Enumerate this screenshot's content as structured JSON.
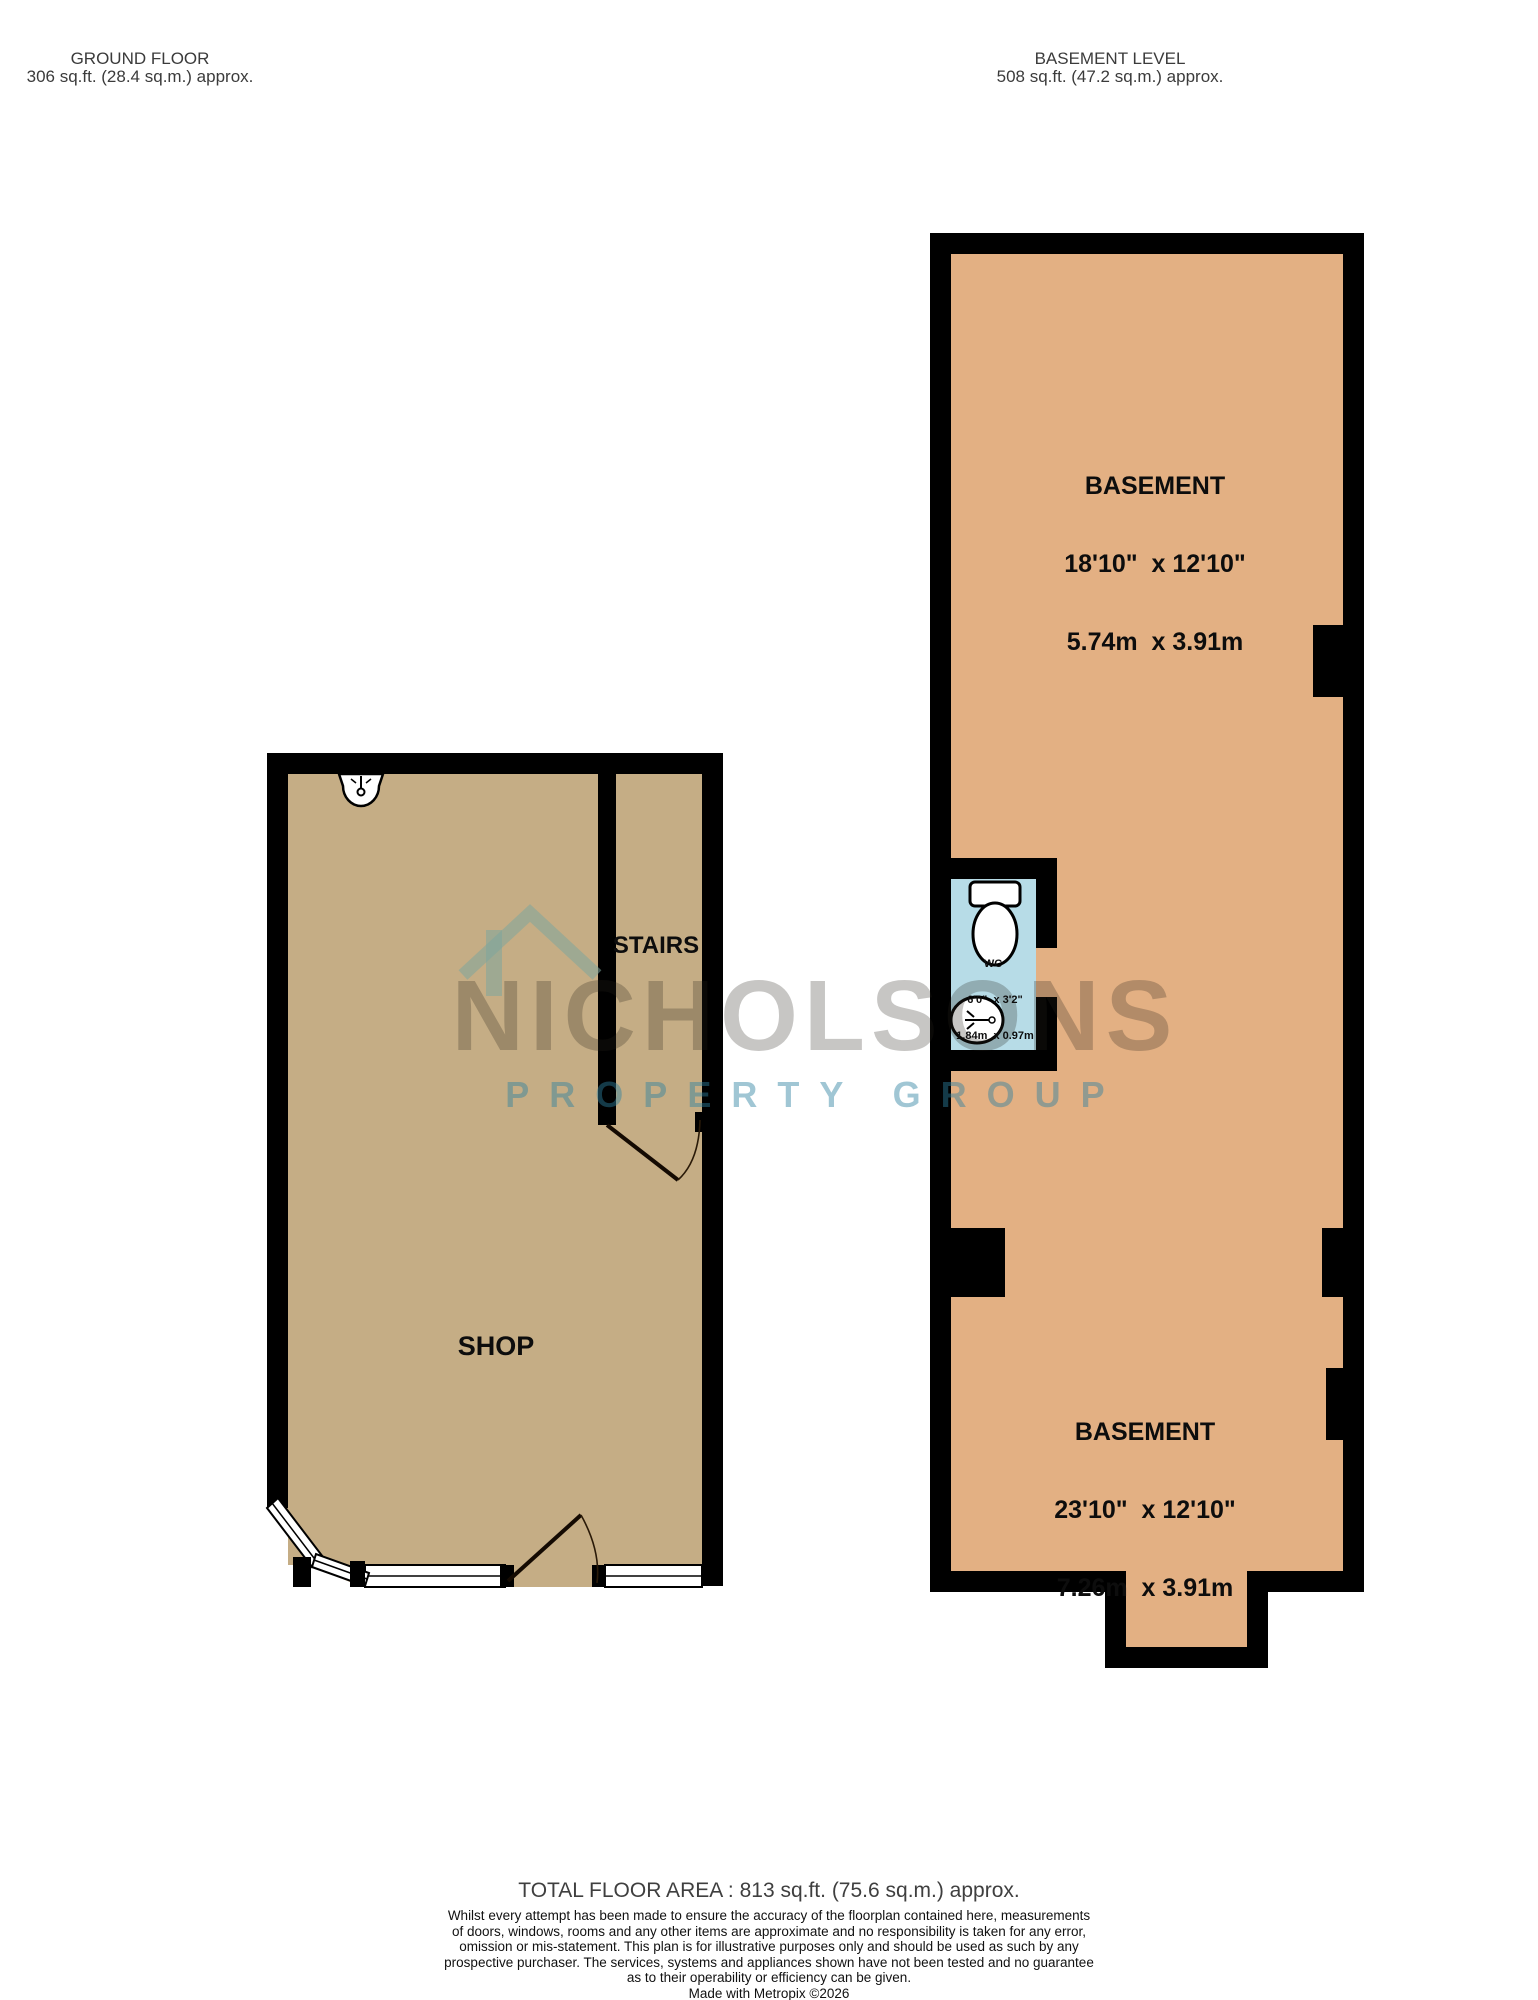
{
  "headers": {
    "ground": {
      "title": "GROUND FLOOR",
      "area": "306 sq.ft. (28.4 sq.m.) approx."
    },
    "basement": {
      "title": "BASEMENT LEVEL",
      "area": "508 sq.ft. (47.2 sq.m.) approx."
    }
  },
  "rooms": {
    "shop": {
      "label": "SHOP"
    },
    "stairs": {
      "label": "STAIRS"
    },
    "basement_upper": {
      "name": "BASEMENT",
      "imperial": "18'10\"  x 12'10\"",
      "metric": "5.74m  x 3.91m"
    },
    "basement_lower": {
      "name": "BASEMENT",
      "imperial": "23'10\"  x 12'10\"",
      "metric": "7.26m  x 3.91m"
    },
    "wc": {
      "label": "WC",
      "imperial": "6'0\"  x 3'2\"",
      "metric": "1.84m  x 0.97m"
    }
  },
  "watermark": {
    "brand": "NICHOLSONS",
    "tagline": "PROPERTY GROUP"
  },
  "footer": {
    "total": "TOTAL FLOOR AREA : 813 sq.ft. (75.6 sq.m.) approx.",
    "disclaimer_lines": [
      "Whilst every attempt has been made to ensure the accuracy of the floorplan contained here, measurements",
      "of doors, windows, rooms and any other items are approximate and no responsibility is taken for any error,",
      "omission or mis-statement. This plan is for illustrative purposes only and should be used as such by any",
      "prospective purchaser. The services, systems and appliances shown have not been tested and no guarantee",
      "as to their operability or efficiency can be given."
    ],
    "credit": "Made with Metropix ©2026"
  },
  "colors": {
    "wall": "#000000",
    "basement_fill": "#e3b083",
    "shop_fill": "#c5ad85",
    "wc_fill": "#b7dce7",
    "watermark_teal": "#7da59c"
  }
}
